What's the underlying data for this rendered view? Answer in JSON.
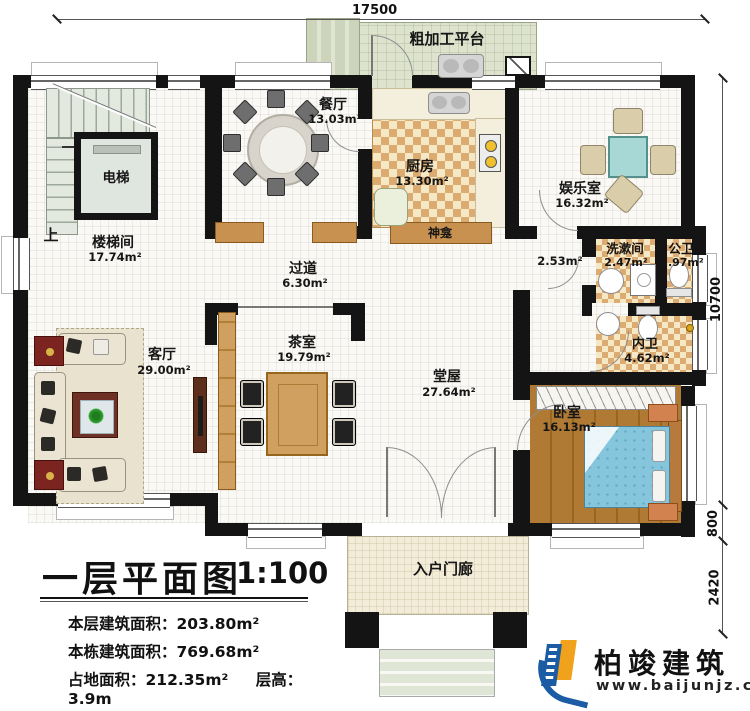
{
  "plan": {
    "dim_top": "17500",
    "dim_right_upper": "10700",
    "dim_right_mid": "800",
    "dim_right_lower": "2420"
  },
  "rooms": {
    "stair_hall": {
      "name": "楼梯间",
      "area": "17.74m²"
    },
    "dining": {
      "name": "餐厅",
      "area": "13.03m²"
    },
    "kitchen": {
      "name": "厨房",
      "area": "13.30m²"
    },
    "entertainment": {
      "name": "娱乐室",
      "area": "16.32m²"
    },
    "hallway": {
      "name": "过道",
      "area": "6.30m²"
    },
    "living": {
      "name": "客厅",
      "area": "29.00m²"
    },
    "tea": {
      "name": "茶室",
      "area": "19.79m²"
    },
    "main_hall": {
      "name": "堂屋",
      "area": "27.64m²"
    },
    "bedroom": {
      "name": "卧室",
      "area": "16.13m²"
    },
    "washroom": {
      "name": "洗漱间",
      "area": "2.47m²"
    },
    "public_wc": {
      "name": "公卫",
      "area": "1.97m²"
    },
    "inner_wc": {
      "name": "内卫",
      "area": "4.62m²"
    },
    "corridor": {
      "area": "2.53m²"
    },
    "platform": {
      "name": "粗加工平台"
    },
    "porch": {
      "name": "入户门廊"
    },
    "shrine": {
      "name": "神龛"
    }
  },
  "labels": {
    "up": "上",
    "elevator": "电梯"
  },
  "title_block": {
    "title": "一层平面图",
    "scale": "1:100",
    "floor_area_label": "本层建筑面积：",
    "floor_area_value": "203.80m²",
    "building_area_label": "本栋建筑面积：",
    "building_area_value": "769.68m²",
    "land_area_label": "占地面积：",
    "land_area_value": "212.35m²",
    "height_label": "层高：",
    "height_value": "3.9m"
  },
  "logo": {
    "company": "柏竣建筑",
    "website": "www.baijunjz.com"
  },
  "colors": {
    "wall": "#141414",
    "logo_blue": "#1b5ca4",
    "logo_orange": "#f0a21c",
    "checker_tan": "#dcab72",
    "bed_blue": "#86c6dc"
  }
}
